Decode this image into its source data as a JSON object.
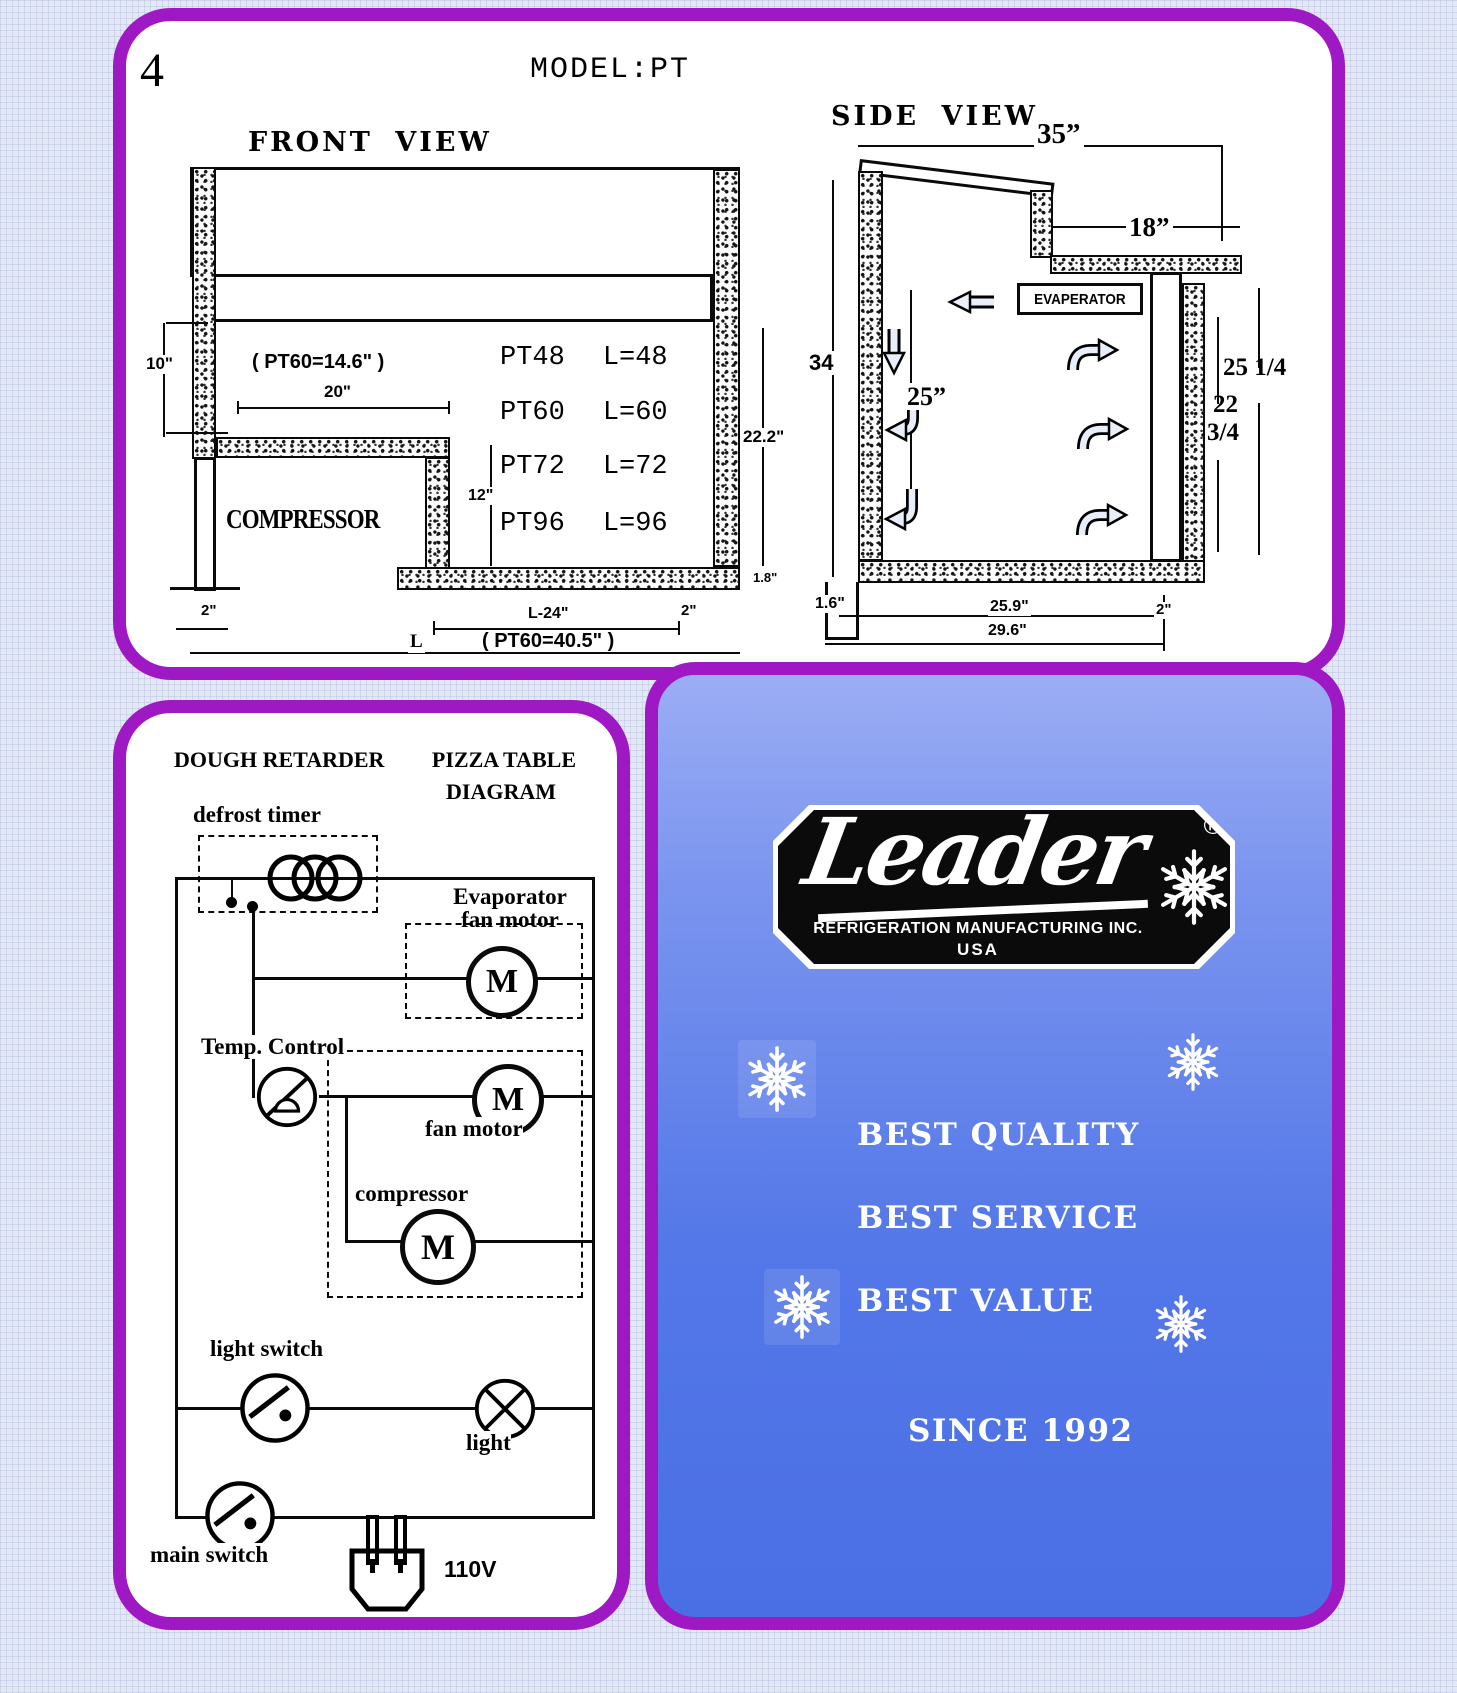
{
  "page_number": "4",
  "top_panel": {
    "model_title": "MODEL:PT",
    "front_view": {
      "title": "FRONT VIEW",
      "compressor": "COMPRESSOR",
      "dim_10": "10\"",
      "pt60_note_top": "( PT60=14.6\" )",
      "dim_20": "20\"",
      "dim_22_2": "22.2\"",
      "dim_12": "12\"",
      "dim_1_8": "1.8\"",
      "dim_2_left": "2\"",
      "dim_l_24": "L-24\"",
      "dim_2_right": "2\"",
      "label_l": "L",
      "pt60_note_bottom": "( PT60=40.5\" )",
      "models": [
        {
          "name": "PT48",
          "length": "L=48"
        },
        {
          "name": "PT60",
          "length": "L=60"
        },
        {
          "name": "PT72",
          "length": "L=72"
        },
        {
          "name": "PT96",
          "length": "L=96"
        }
      ]
    },
    "side_view": {
      "title": "SIDE VIEW",
      "dim_35": "35”",
      "dim_18": "18”",
      "dim_34": "34",
      "dim_25": "25”",
      "evaporator": "EVAPERATOR",
      "dim_25_14": "25 1/4",
      "dim_22_34_line1": "22",
      "dim_22_34_line2": "3/4",
      "dim_1_6": "1.6\"",
      "dim_25_9": "25.9\"",
      "dim_2_right": "2\"",
      "dim_29_6": "29.6\""
    }
  },
  "wiring": {
    "title_left": "DOUGH RETARDER",
    "title_right": "PIZZA TABLE",
    "title_line2": "DIAGRAM",
    "defrost_timer": "defrost timer",
    "evaporator_line1": "Evaporator",
    "evaporator_line2": "fan motor",
    "temp_control": "Temp. Control",
    "fan_motor": "fan motor",
    "compressor": "compressor",
    "motor_m": "M",
    "light_switch": "light switch",
    "light": "light",
    "main_switch": "main switch",
    "voltage": "110V"
  },
  "brand": {
    "logo_script": "Leader",
    "registered": "®",
    "logo_line1": "REFRIGERATION MANUFACTURING INC.",
    "logo_line2": "USA",
    "slogan1": "BEST QUALITY",
    "slogan2": "BEST SERVICE",
    "slogan3": "BEST VALUE",
    "since": "SINCE 1992"
  },
  "colors": {
    "accent_purple": "#9E18C4",
    "panel_blue_top": "#9BADF4",
    "panel_blue_bottom": "#4A6FE5",
    "badge_black": "#0b0b0b"
  }
}
